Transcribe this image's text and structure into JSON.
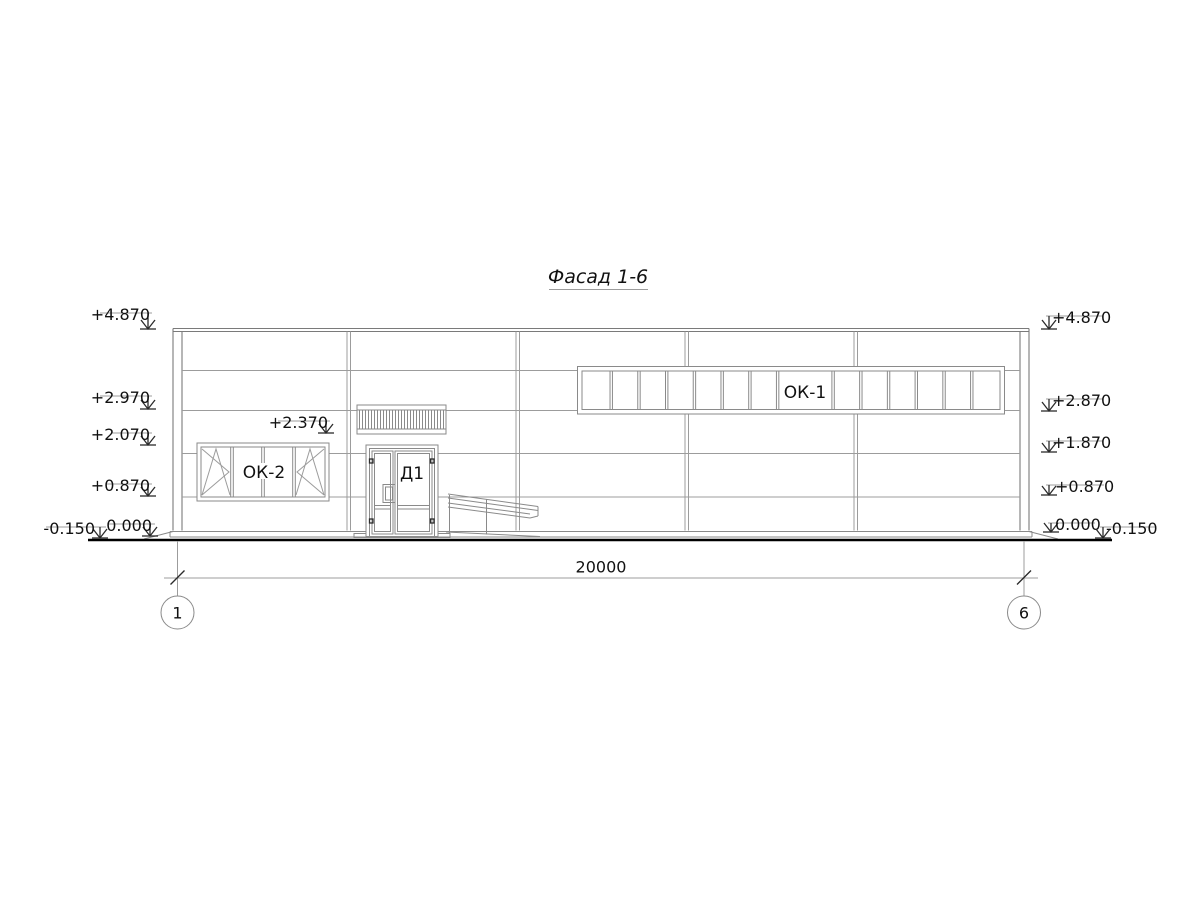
{
  "drawing": {
    "title": "Фасад 1-6",
    "dimension_total": "20000",
    "grid_axes": [
      "1",
      "6"
    ],
    "elevation_marks_left": [
      "+4.870",
      "+2.970",
      "+2.070",
      "+0.870",
      "0.000",
      "-0.150"
    ],
    "elevation_marks_right": [
      "+4.870",
      "+2.870",
      "+1.870",
      "+0.870",
      "0.000",
      "-0.150"
    ],
    "louver_mark": "+2.370",
    "windows": {
      "ok1": {
        "label": "ОК-1",
        "panes": 15
      },
      "ok2": {
        "label": "ОК-2",
        "panes": 4
      }
    },
    "door": {
      "label": "Д1"
    },
    "colors": {
      "background": "#ffffff",
      "line_thin": "#9c9c9c",
      "line_frame": "#8a8a8a",
      "line_dark": "#2b2b2b",
      "text": "#111111"
    }
  }
}
